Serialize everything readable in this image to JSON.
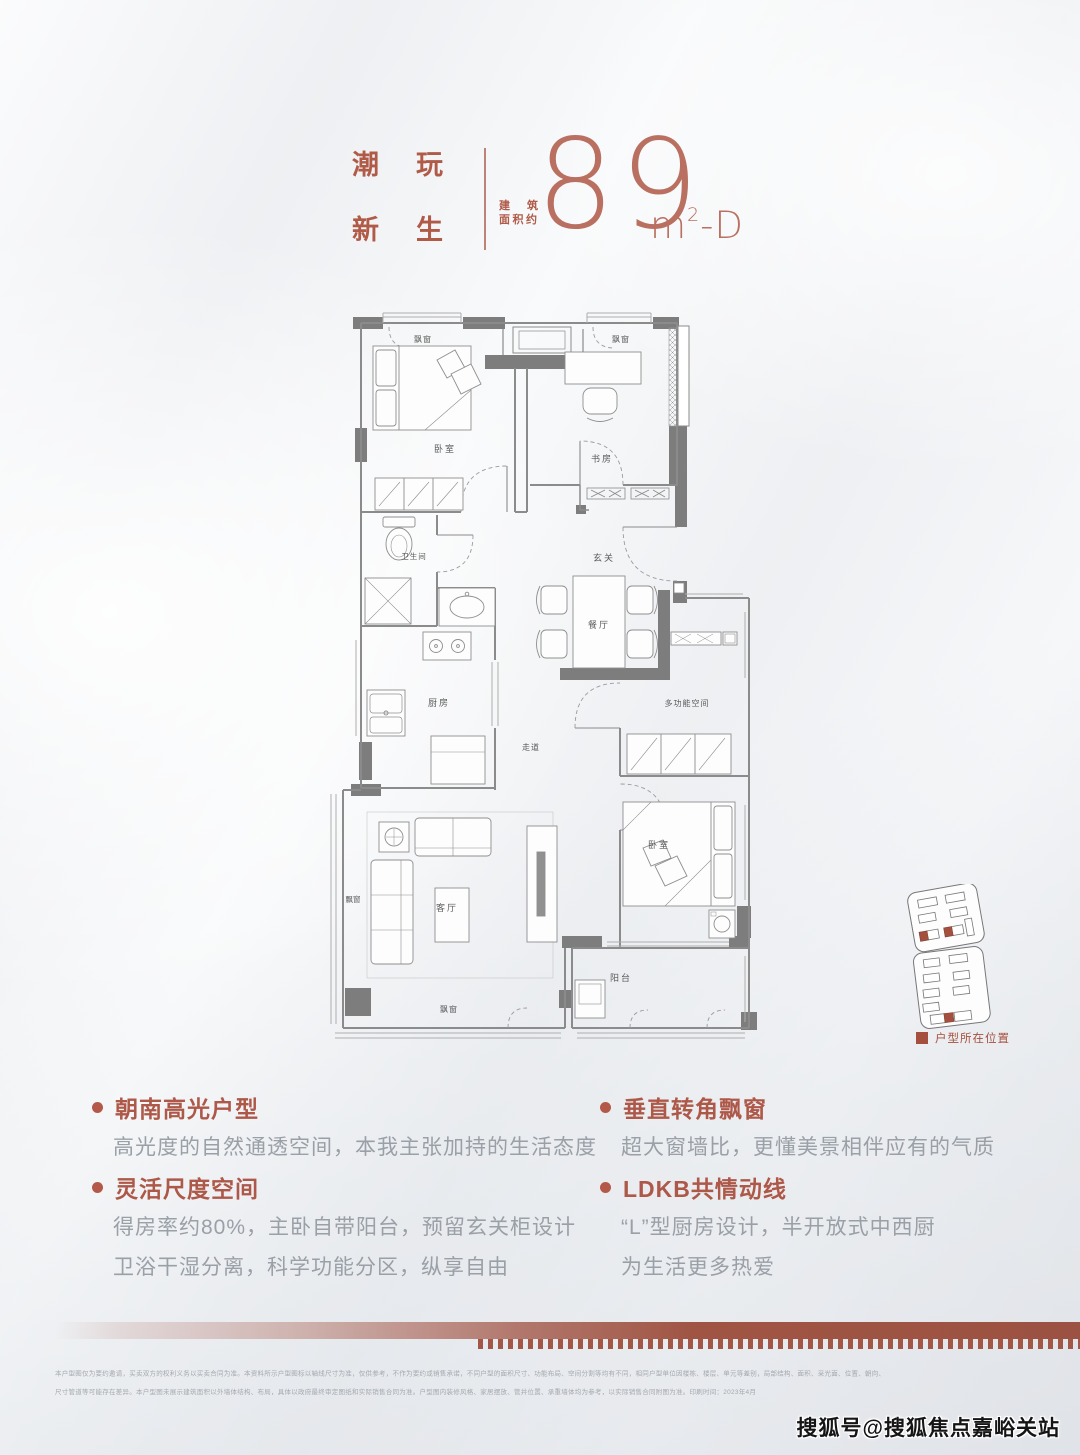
{
  "header": {
    "accent": "#b05a48",
    "title_line1": "潮玩",
    "title_line2": "新生",
    "area_label_line1": "建筑",
    "area_label_line2": "面积约",
    "area_number": "89",
    "area_unit_base": "m",
    "area_unit_sup": "2",
    "area_unit_suffix": "-D"
  },
  "floorplan": {
    "wall_color": "#7d7d7d",
    "labels": {
      "bay_window": "飘窗",
      "bedroom_top": "卧室",
      "study": "书房",
      "bathroom": "卫生间",
      "foyer": "玄关",
      "dining": "餐厅",
      "kitchen": "厨房",
      "corridor": "走道",
      "multi_room": "多功能空间",
      "bedroom_master": "卧室",
      "balcony": "阳台",
      "living": "客厅"
    }
  },
  "sitemap": {
    "legend_label": "户型所在位置",
    "highlight_color": "#a5503e"
  },
  "features": {
    "left": [
      {
        "title": "朝南高光户型",
        "lines": [
          "高光度的自然通透空间，本我主张加持的生活态度"
        ]
      },
      {
        "title": "灵活尺度空间",
        "lines": [
          "得房率约80%，主卧自带阳台，预留玄关柜设计",
          "卫浴干湿分离，科学功能分区，纵享自由"
        ]
      }
    ],
    "right": [
      {
        "title": "垂直转角飘窗",
        "lines": [
          "超大窗墙比，更懂美景相伴应有的气质"
        ]
      },
      {
        "title": "LDKB共情动线",
        "lines": [
          "“L”型厨房设计，半开放式中西厨",
          "为生活更多热爱"
        ]
      }
    ]
  },
  "footer": {
    "strip_color": "#a05544",
    "disclaimer_line1": "本户型图仅为要约邀请，买卖双方的权利义务以买卖合同为准。本资料所示户型图标以轴线尺寸为准，仅供参考，不作为要约或销售承诺，不同户型的面积尺寸、功能布局、空间分割等均有不同，相同户型单位因楼栋、楼层、单元等差别，局部结构、面积、采光面、位置、朝向、",
    "disclaimer_line2": "尺寸管道等可能存在差异。本户型图未展示建筑面积以外墙体结构、布局，具体以政府最终审定图纸和实际销售合同为准。户型图内装修风格、家居摆放、管井位置、承重墙体均为参考，以实际销售合同附图为准。印刷时间：2023年4月",
    "watermark": "搜狐号@搜狐焦点嘉峪关站"
  }
}
